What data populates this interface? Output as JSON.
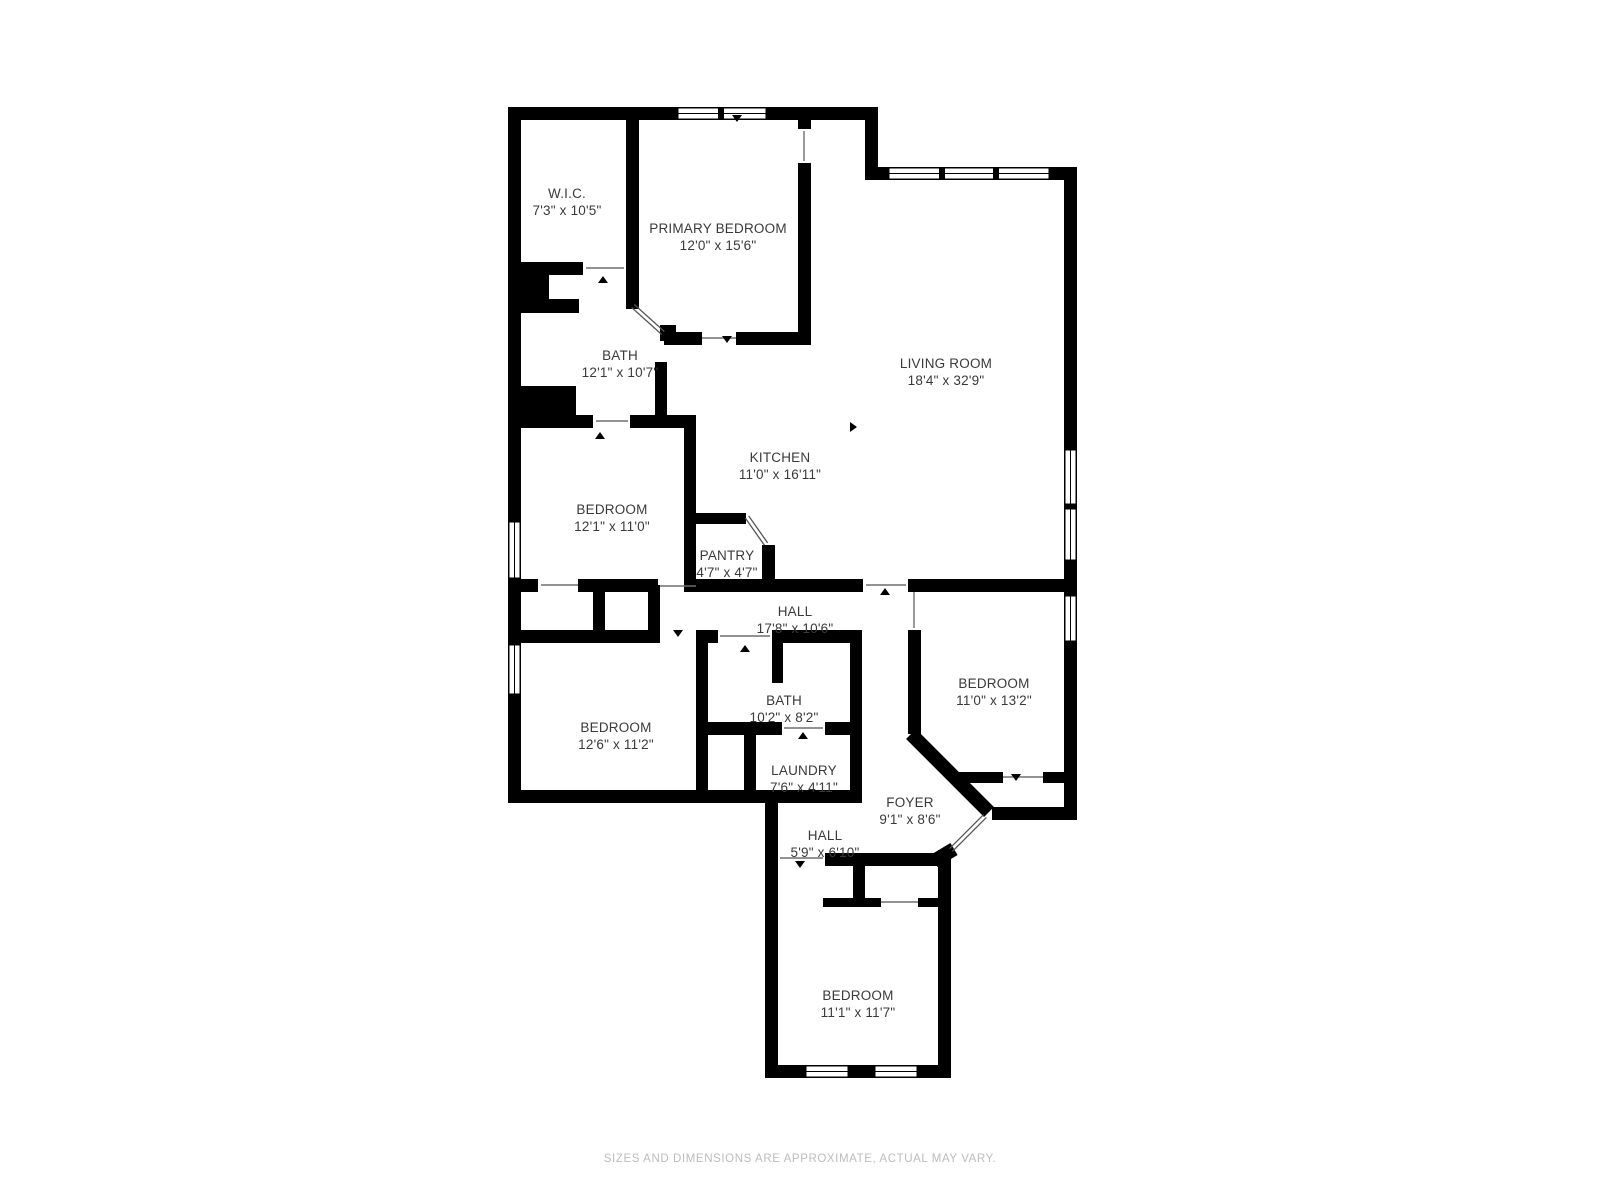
{
  "page": {
    "footer": "SIZES AND DIMENSIONS ARE APPROXIMATE, ACTUAL MAY VARY."
  },
  "palette": {
    "background": "#ffffff",
    "wall": "#000000",
    "label_text": "#3a3a3a",
    "footer_text": "#bcbcbc",
    "opening_line": "#6e6e6e",
    "door_leaf_line": "#555555"
  },
  "floorplan": {
    "rooms": [
      {
        "name": "W.I.C.",
        "dims": "7'3\" x 10'5\"",
        "x": 567,
        "y": 185
      },
      {
        "name": "PRIMARY BEDROOM",
        "dims": "12'0\" x 15'6\"",
        "x": 718,
        "y": 220
      },
      {
        "name": "LIVING ROOM",
        "dims": "18'4\" x 32'9\"",
        "x": 946,
        "y": 355
      },
      {
        "name": "BATH",
        "dims": "12'1\" x 10'7\"",
        "x": 620,
        "y": 347
      },
      {
        "name": "KITCHEN",
        "dims": "11'0\" x 16'11\"",
        "x": 780,
        "y": 449
      },
      {
        "name": "BEDROOM",
        "dims": "12'1\" x 11'0\"",
        "x": 612,
        "y": 501
      },
      {
        "name": "PANTRY",
        "dims": "4'7\" x 4'7\"",
        "x": 727,
        "y": 547
      },
      {
        "name": "HALL",
        "dims": "17'8\" x 10'6\"",
        "x": 795,
        "y": 603
      },
      {
        "name": "BEDROOM",
        "dims": "11'0\" x 13'2\"",
        "x": 994,
        "y": 675
      },
      {
        "name": "BATH",
        "dims": "10'2\" x 8'2\"",
        "x": 784,
        "y": 692
      },
      {
        "name": "BEDROOM",
        "dims": "12'6\" x 11'2\"",
        "x": 616,
        "y": 719
      },
      {
        "name": "LAUNDRY",
        "dims": "7'6\" x 4'11\"",
        "x": 804,
        "y": 762
      },
      {
        "name": "FOYER",
        "dims": "9'1\" x 8'6\"",
        "x": 910,
        "y": 794
      },
      {
        "name": "HALL",
        "dims": "5'9\" x 6'10\"",
        "x": 825,
        "y": 827
      },
      {
        "name": "BEDROOM",
        "dims": "11'1\" x 11'7\"",
        "x": 858,
        "y": 987
      }
    ],
    "walls": [
      [
        508,
        107,
        370,
        13
      ],
      [
        865,
        107,
        13,
        73
      ],
      [
        865,
        167,
        212,
        13
      ],
      [
        1064,
        167,
        13,
        653
      ],
      [
        992,
        807,
        85,
        13
      ],
      [
        508,
        107,
        13,
        690
      ],
      [
        508,
        790,
        354,
        13
      ],
      [
        765,
        790,
        13,
        288
      ],
      [
        765,
        1065,
        186,
        13
      ],
      [
        938,
        850,
        13,
        228
      ],
      [
        825,
        853,
        113,
        13
      ],
      [
        853,
        853,
        12,
        52
      ],
      [
        823,
        898,
        58,
        9
      ],
      [
        918,
        898,
        20,
        9
      ],
      [
        908,
        630,
        13,
        104
      ],
      [
        955,
        772,
        48,
        11
      ],
      [
        1043,
        772,
        25,
        11
      ],
      [
        508,
        579,
        30,
        13
      ],
      [
        578,
        579,
        80,
        13
      ],
      [
        696,
        579,
        167,
        13
      ],
      [
        908,
        579,
        169,
        13
      ],
      [
        593,
        585,
        12,
        55
      ],
      [
        648,
        585,
        12,
        55
      ],
      [
        593,
        630,
        67,
        13
      ],
      [
        508,
        630,
        97,
        13
      ],
      [
        700,
        630,
        18,
        13
      ],
      [
        772,
        630,
        90,
        13
      ],
      [
        772,
        643,
        11,
        40
      ],
      [
        508,
        262,
        75,
        13
      ],
      [
        626,
        107,
        13,
        202
      ],
      [
        664,
        332,
        38,
        13
      ],
      [
        736,
        332,
        66,
        13
      ],
      [
        798,
        115,
        13,
        14
      ],
      [
        798,
        163,
        13,
        182
      ],
      [
        521,
        266,
        28,
        47
      ],
      [
        521,
        299,
        58,
        14
      ],
      [
        521,
        386,
        55,
        30
      ],
      [
        655,
        362,
        12,
        66
      ],
      [
        508,
        415,
        85,
        13
      ],
      [
        630,
        415,
        66,
        13
      ],
      [
        684,
        415,
        12,
        177
      ],
      [
        696,
        513,
        50,
        11
      ],
      [
        762,
        545,
        13,
        45
      ],
      [
        696,
        630,
        12,
        173
      ],
      [
        708,
        722,
        74,
        13
      ],
      [
        825,
        722,
        37,
        13
      ],
      [
        744,
        735,
        12,
        58
      ],
      [
        850,
        630,
        12,
        173
      ],
      [
        660,
        325,
        16,
        16
      ]
    ],
    "diag_walls": [
      [
        911,
        734,
        989,
        812
      ],
      [
        954,
        849,
        934,
        861
      ]
    ],
    "door_leaves": [
      [
        633,
        306,
        663,
        333
      ],
      [
        747,
        517,
        766,
        544
      ],
      [
        985,
        816,
        951,
        850
      ]
    ],
    "openings": [
      [
        541,
        585,
        578,
        585
      ],
      [
        660,
        586,
        696,
        586
      ],
      [
        702,
        338,
        736,
        338
      ],
      [
        596,
        421,
        628,
        421
      ],
      [
        720,
        636,
        770,
        636
      ],
      [
        784,
        728,
        823,
        728
      ],
      [
        586,
        268,
        624,
        268
      ],
      [
        914,
        592,
        914,
        628
      ],
      [
        804,
        131,
        804,
        161
      ],
      [
        881,
        902,
        918,
        902
      ],
      [
        1003,
        777,
        1043,
        777
      ],
      [
        780,
        858,
        823,
        858
      ],
      [
        866,
        585,
        906,
        585
      ]
    ],
    "windows": [
      {
        "x": 677,
        "y": 107,
        "w": 90,
        "h": 13,
        "m": [
          721
        ]
      },
      {
        "x": 888,
        "y": 167,
        "w": 162,
        "h": 13,
        "m": [
          942,
          996
        ]
      },
      {
        "x": 1064,
        "y": 449,
        "w": 13,
        "h": 56,
        "m": []
      },
      {
        "x": 1064,
        "y": 508,
        "w": 13,
        "h": 53,
        "m": []
      },
      {
        "x": 1064,
        "y": 595,
        "w": 13,
        "h": 47,
        "m": []
      },
      {
        "x": 508,
        "y": 521,
        "w": 13,
        "h": 58,
        "m": []
      },
      {
        "x": 508,
        "y": 644,
        "w": 13,
        "h": 51,
        "m": []
      },
      {
        "x": 805,
        "y": 1065,
        "w": 44,
        "h": 13,
        "m": []
      },
      {
        "x": 874,
        "y": 1065,
        "w": 44,
        "h": 13,
        "m": []
      }
    ],
    "ticks": [
      {
        "x": 603,
        "y": 276,
        "d": "u"
      },
      {
        "x": 600,
        "y": 432,
        "d": "u"
      },
      {
        "x": 613,
        "y": 591,
        "d": "d"
      },
      {
        "x": 678,
        "y": 637,
        "d": "d"
      },
      {
        "x": 727,
        "y": 343,
        "d": "d"
      },
      {
        "x": 745,
        "y": 645,
        "d": "u"
      },
      {
        "x": 803,
        "y": 732,
        "d": "u"
      },
      {
        "x": 885,
        "y": 588,
        "d": "u"
      },
      {
        "x": 1016,
        "y": 781,
        "d": "d"
      },
      {
        "x": 800,
        "y": 868,
        "d": "d"
      },
      {
        "x": 737,
        "y": 122,
        "d": "d"
      },
      {
        "x": 857,
        "y": 427,
        "d": "r"
      }
    ]
  }
}
